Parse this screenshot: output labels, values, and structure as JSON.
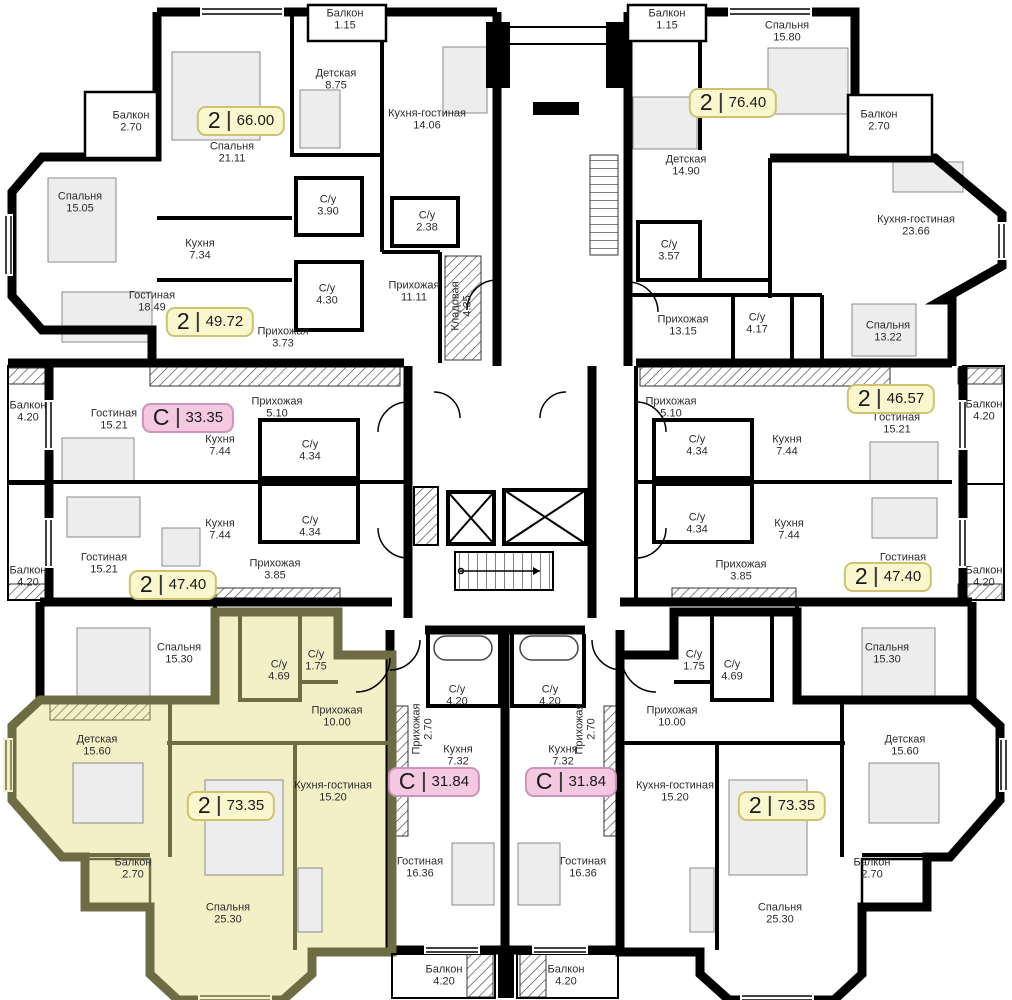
{
  "colors": {
    "badge-yellow-bg": "#FAF6CE",
    "badge-yellow-border": "#CFC272",
    "badge-pink-bg": "#F4C8E0",
    "badge-pink-border": "#CE93BB",
    "highlight-fill": "#F3F0C7",
    "highlight-wall": "#6E6C45",
    "wall": "#000000",
    "label": "#2B2B2B"
  },
  "badges": [
    {
      "rooms": "2",
      "area": "66.00",
      "x": 241,
      "y": 121,
      "style": "yellow"
    },
    {
      "rooms": "2",
      "area": "76.40",
      "x": 733,
      "y": 103,
      "style": "yellow"
    },
    {
      "rooms": "2",
      "area": "49.72",
      "x": 210,
      "y": 322,
      "style": "yellow"
    },
    {
      "rooms": "С",
      "area": "33.35",
      "x": 188,
      "y": 418,
      "style": "pink"
    },
    {
      "rooms": "2",
      "area": "46.57",
      "x": 891,
      "y": 399,
      "style": "yellow"
    },
    {
      "rooms": "2",
      "area": "47.40",
      "x": 173,
      "y": 585,
      "style": "yellow"
    },
    {
      "rooms": "2",
      "area": "47.40",
      "x": 888,
      "y": 577,
      "style": "yellow"
    },
    {
      "rooms": "2",
      "area": "73.35",
      "x": 231,
      "y": 806,
      "style": "yellow"
    },
    {
      "rooms": "2",
      "area": "73.35",
      "x": 782,
      "y": 806,
      "style": "yellow"
    },
    {
      "rooms": "С",
      "area": "31.84",
      "x": 434,
      "y": 782,
      "style": "pink"
    },
    {
      "rooms": "С",
      "area": "31.84",
      "x": 571,
      "y": 782,
      "style": "pink"
    }
  ],
  "rooms": [
    {
      "name": "Балкон",
      "area": "2.70",
      "x": 131,
      "y": 122
    },
    {
      "name": "Спальня",
      "area": "21.11",
      "x": 232,
      "y": 153
    },
    {
      "name": "Спальня",
      "area": "15.05",
      "x": 80,
      "y": 203
    },
    {
      "name": "Детская",
      "area": "8.75",
      "x": 336,
      "y": 80
    },
    {
      "name": "Кухня",
      "area": "7.34",
      "x": 200,
      "y": 250
    },
    {
      "name": "Гостиная",
      "area": "18.49",
      "x": 152,
      "y": 302
    },
    {
      "name": "С/у",
      "area": "3.90",
      "x": 328,
      "y": 206
    },
    {
      "name": "С/у",
      "area": "4.30",
      "x": 327,
      "y": 295
    },
    {
      "name": "Прихожая",
      "area": "3.73",
      "x": 283,
      "y": 338
    },
    {
      "name": "Балкон",
      "area": "1.15",
      "x": 345,
      "y": 20
    },
    {
      "name": "Кухня-гостиная",
      "area": "14.06",
      "x": 427,
      "y": 120
    },
    {
      "name": "С/у",
      "area": "2.38",
      "x": 427,
      "y": 222
    },
    {
      "name": "Прихожая",
      "area": "11.11",
      "x": 414,
      "y": 292
    },
    {
      "name": "Кладовая",
      "area": "4.35",
      "x": 462,
      "y": 306,
      "rot": -90
    },
    {
      "name": "Балкон",
      "area": "1.15",
      "x": 667,
      "y": 20
    },
    {
      "name": "Спальня",
      "area": "15.80",
      "x": 787,
      "y": 32
    },
    {
      "name": "Детская",
      "area": "14.90",
      "x": 686,
      "y": 166
    },
    {
      "name": "Балкон",
      "area": "2.70",
      "x": 879,
      "y": 121
    },
    {
      "name": "Кухня-гостиная 23.66",
      "area": "",
      "x": 916,
      "y": 226
    },
    {
      "name": "С/у",
      "area": "3.57",
      "x": 669,
      "y": 251
    },
    {
      "name": "Прихожая",
      "area": "13.15",
      "x": 683,
      "y": 326
    },
    {
      "name": "С/у",
      "area": "4.17",
      "x": 757,
      "y": 324
    },
    {
      "name": "Спальня",
      "area": "13.22",
      "x": 888,
      "y": 332
    },
    {
      "name": "Балкон",
      "area": "4.20",
      "x": 28,
      "y": 412
    },
    {
      "name": "Гостиная",
      "area": "15.21",
      "x": 114,
      "y": 420
    },
    {
      "name": "Прихожая",
      "area": "5.10",
      "x": 277,
      "y": 408
    },
    {
      "name": "Кухня",
      "area": "7.44",
      "x": 220,
      "y": 446
    },
    {
      "name": "С/у",
      "area": "4.34",
      "x": 310,
      "y": 451
    },
    {
      "name": "Кухня",
      "area": "7.44",
      "x": 220,
      "y": 530
    },
    {
      "name": "С/у",
      "area": "4.34",
      "x": 310,
      "y": 527
    },
    {
      "name": "Гостиная",
      "area": "15.21",
      "x": 104,
      "y": 564
    },
    {
      "name": "Балкон",
      "area": "4.20",
      "x": 28,
      "y": 577
    },
    {
      "name": "Прихожая",
      "area": "3.85",
      "x": 275,
      "y": 570
    },
    {
      "name": "Прихожая",
      "area": "5.10",
      "x": 671,
      "y": 408
    },
    {
      "name": "С/у",
      "area": "4.34",
      "x": 697,
      "y": 446
    },
    {
      "name": "Кухня",
      "area": "7.44",
      "x": 787,
      "y": 446
    },
    {
      "name": "Гостиная",
      "area": "15.21",
      "x": 897,
      "y": 424
    },
    {
      "name": "Балкон",
      "area": "4.20",
      "x": 984,
      "y": 411
    },
    {
      "name": "С/у",
      "area": "4.34",
      "x": 697,
      "y": 524
    },
    {
      "name": "Кухня",
      "area": "7.44",
      "x": 789,
      "y": 530
    },
    {
      "name": "Гостиная",
      "area": "15.21",
      "x": 903,
      "y": 564
    },
    {
      "name": "Балкон",
      "area": "4.20",
      "x": 984,
      "y": 577
    },
    {
      "name": "Прихожая",
      "area": "3.85",
      "x": 741,
      "y": 571
    },
    {
      "name": "Спальня",
      "area": "15.30",
      "x": 179,
      "y": 654
    },
    {
      "name": "С/у",
      "area": "4.69",
      "x": 279,
      "y": 671
    },
    {
      "name": "С/у",
      "area": "1.75",
      "x": 316,
      "y": 661
    },
    {
      "name": "Прихожая",
      "area": "10.00",
      "x": 337,
      "y": 717
    },
    {
      "name": "Детская",
      "area": "15.60",
      "x": 97,
      "y": 746
    },
    {
      "name": "Кухня-гостиная",
      "area": "15.20",
      "x": 333,
      "y": 792
    },
    {
      "name": "Балкон",
      "area": "2.70",
      "x": 133,
      "y": 869
    },
    {
      "name": "Спальня",
      "area": "25.30",
      "x": 228,
      "y": 914
    },
    {
      "name": "С/у",
      "area": "4.20",
      "x": 457,
      "y": 696
    },
    {
      "name": "Прихожая",
      "area": "2.70",
      "x": 423,
      "y": 729,
      "rot": -90
    },
    {
      "name": "Кухня",
      "area": "7.32",
      "x": 458,
      "y": 756
    },
    {
      "name": "Гостиная",
      "area": "16.36",
      "x": 420,
      "y": 868
    },
    {
      "name": "Балкон",
      "area": "4.20",
      "x": 444,
      "y": 976
    },
    {
      "name": "С/у",
      "area": "4.20",
      "x": 550,
      "y": 696
    },
    {
      "name": "Прихожая",
      "area": "2.70",
      "x": 586,
      "y": 729,
      "rot": -90
    },
    {
      "name": "Кухня",
      "area": "7.32",
      "x": 563,
      "y": 756
    },
    {
      "name": "Гостиная",
      "area": "16.36",
      "x": 583,
      "y": 868
    },
    {
      "name": "Балкон",
      "area": "4.20",
      "x": 566,
      "y": 976
    },
    {
      "name": "С/у",
      "area": "1.75",
      "x": 694,
      "y": 661
    },
    {
      "name": "С/у",
      "area": "4.69",
      "x": 732,
      "y": 671
    },
    {
      "name": "Прихожая",
      "area": "10.00",
      "x": 672,
      "y": 717
    },
    {
      "name": "Спальня",
      "area": "15.30",
      "x": 887,
      "y": 654
    },
    {
      "name": "Детская",
      "area": "15.60",
      "x": 905,
      "y": 746
    },
    {
      "name": "Кухня-гостиная",
      "area": "15.20",
      "x": 675,
      "y": 792
    },
    {
      "name": "Балкон",
      "area": "2.70",
      "x": 872,
      "y": 869
    },
    {
      "name": "Спальня",
      "area": "25.30",
      "x": 780,
      "y": 914
    }
  ]
}
